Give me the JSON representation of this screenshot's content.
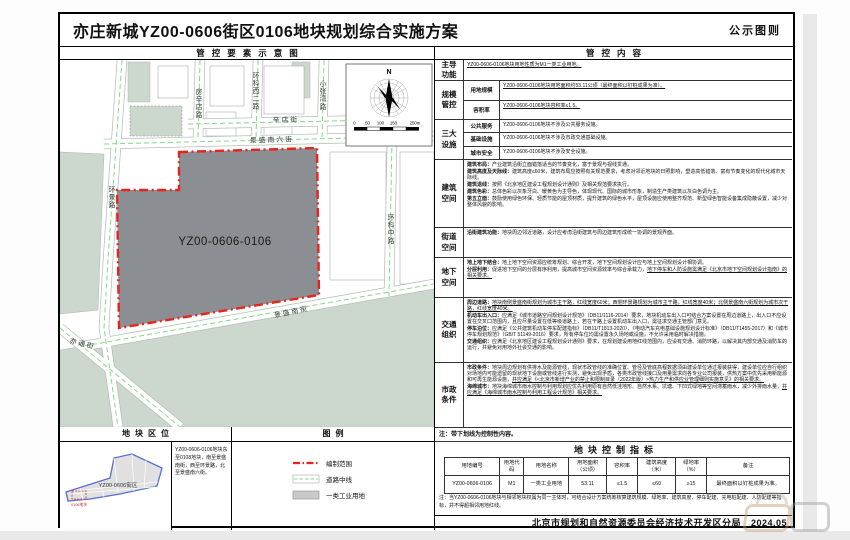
{
  "page": {
    "title": "亦庄新城YZ00-0606街区0106地块规划综合实施方案",
    "title_right": "公示图则",
    "footer_agency": "北京市规划和自然资源委员会经济技术开发区分局",
    "footer_date": "2024.05"
  },
  "map_panel": {
    "header": "管控要素示意图",
    "parcel_label": "YZ00-0606-0106",
    "north_label": "N",
    "scale_ticks": [
      "0",
      "50",
      "100",
      "150",
      "250m"
    ],
    "streets": [
      "房辛店路",
      "环科西二路",
      "辛店街",
      "小张湾路",
      "景盛南六街",
      "环景路",
      "环科中路",
      "景盛南街",
      "亦通街"
    ]
  },
  "location_panel": {
    "header": "地块区位",
    "district_label": "YZ00-0606街区",
    "parcel_label": "0106地块",
    "description": "YZ00-0606-0106地块东至0108地块，南至景盛南街，西至环景路，北至景盛南六街。"
  },
  "legend_panel": {
    "header": "图例",
    "items": [
      {
        "swatch": "red-dashdot-line",
        "label": "编制范围"
      },
      {
        "swatch": "road-centerline",
        "label": "道路中线"
      },
      {
        "swatch": "gray-fill",
        "label": "一类工业用地"
      }
    ]
  },
  "control_panel": {
    "header": "管控内容",
    "note": "注：带下划线为控制性内容。",
    "rows": [
      {
        "label": "主导功能",
        "cells": [
          {
            "sublabel": null,
            "paras": [
              [
                {
                  "t": "YZ00-0606-0106地块用地性质为M1一类工业用地。",
                  "u": 1
                }
              ]
            ]
          }
        ]
      },
      {
        "label": "规模管控",
        "cells": [
          {
            "sublabel": "用地规模",
            "paras": [
              [
                {
                  "t": "YZ00-0606-0106地块用地面积约53.11公顷（最终面积以钉桩成果为准）。",
                  "u": 1
                }
              ]
            ]
          },
          {
            "sublabel": "容积率",
            "paras": [
              [
                {
                  "t": "YZ00-0606-0106地块容积率≤1.5。",
                  "u": 1
                }
              ]
            ]
          }
        ]
      },
      {
        "label": "三大设施",
        "cells": [
          {
            "sublabel": "公共服务",
            "paras": [
              [
                {
                  "t": "YZ00-0606-0106地块不涉及公共服务设施。"
                }
              ]
            ]
          },
          {
            "sublabel": "基础设施",
            "paras": [
              [
                {
                  "t": "YZ00-0606-0106地块不涉及市政交通基础设施。"
                }
              ]
            ]
          },
          {
            "sublabel": "城市安全",
            "paras": [
              [
                {
                  "t": "YZ00-0606-0106地块不涉及安全设施。"
                }
              ]
            ]
          }
        ]
      },
      {
        "label": "建筑空间",
        "cells": [
          {
            "sublabel": null,
            "paras": [
              [
                {
                  "t": "建筑布局：",
                  "b": 1
                },
                {
                  "t": "产业建筑沿街立面错落适当的节奏变化，富于景观与视线贯通。"
                }
              ],
              [
                {
                  "t": "建筑高度及天际线：",
                  "b": 1
                },
                {
                  "t": "建筑高度≤60米，建筑布局应按照有关规范要求，考虑对邻近地块的日照影响，塑造高低错落、富有节奏变化的现代化城市天际线。"
                }
              ],
              [
                {
                  "t": "建筑退线：",
                  "b": 1
                },
                {
                  "t": "按照《北京地区建设工程规划设计通则》及相关规范要求执行。"
                }
              ],
              [
                {
                  "t": "建筑色彩：",
                  "b": 1
                },
                {
                  "t": "总体色彩以灰象牙白、暖黄色为主导色，体现现代、国际的城市形象，制造生产类建筑以灰白色调为主。"
                }
              ],
              [
                {
                  "t": "第五立面：",
                  "b": 1
                },
                {
                  "t": "鼓励使用绿色环保、轻质节能的屋顶材质，提升建筑的绿色水平，屋顶设施应使用整齐规范、新型绿色智能设备集成隐蔽设置，减少对整体风貌的影响。"
                }
              ]
            ]
          }
        ]
      },
      {
        "label": "街道空间",
        "cells": [
          {
            "sublabel": null,
            "paras": [
              [
                {
                  "t": "沿街建筑功能：",
                  "b": 1
                },
                {
                  "t": "地块周边邻近道路，设计应考虑沿街建筑与周边建筑形成统一协调的景观界面。"
                }
              ]
            ]
          }
        ]
      },
      {
        "label": "地下空间",
        "cells": [
          {
            "sublabel": null,
            "paras": [
              [
                {
                  "t": "地上地下结合：",
                  "b": 1
                },
                {
                  "t": "地上地下空间资源应统筹规划、综合开发，地下空间规划设计应与地上空间规划设计相协调。"
                }
              ],
              [
                {
                  "t": "分层利用：",
                  "b": 1
                },
                {
                  "t": "促进地下空间的分层有序利用，提高城市空间资源效率与综合承载力，"
                },
                {
                  "t": "地下停车和人防设施需满足《北京市地下空间规划设计指南》的相关要求。",
                  "u": 1
                }
              ]
            ]
          }
        ]
      },
      {
        "label": "交通组织",
        "cells": [
          {
            "sublabel": null,
            "paras": [
              [
                {
                  "t": "周边道路：",
                  "b": 1
                },
                {
                  "t": "地块南侧景盛南街规划为城市主干路，红线宽度60米；西侧环景路规划为城市主干路，红线宽度40米；北侧景盛南六街规划为城市次干路，红线宽度40米。",
                  "u": 1
                }
              ],
              [
                {
                  "t": "机动车出入口：",
                  "b": 1
                },
                {
                  "t": "应满足《城市道路空间规划设计规范》（DB11/1116-2014）要求，地块机动车出入口可结合方案设置在周边道路上，出入口不应设置在交叉口范围内，且应尽量设置在低等级道路上，若在干路上设置机动车出入口，需征求交通主管部门意见。"
                }
              ],
              [
                {
                  "t": "停车泊位：",
                  "b": 1
                },
                {
                  "t": "应满足《公共建筑机动车停车配建指标》（DB11/T1813-2020）、《电动汽车充电基础设施规划设计标准》（DB11/T1455-2017）和《城市停车规划规范》（GB/T 51149-2016）要求，所有停车位均需设置永久场地或设施，不允许采用临时解决措施。"
                }
              ],
              [
                {
                  "t": "交通组织：",
                  "b": 1
                },
                {
                  "t": "应满足《北京地区建设工程规划设计通则》要求，在规划建设用地红线范围内，应设有交通、消防环路，以解决其内部交通及消防车的运行，并避免对用地外社会交通的影响。"
                }
              ]
            ]
          }
        ]
      },
      {
        "label": "市政条件",
        "cells": [
          {
            "sublabel": null,
            "paras": [
              [
                {
                  "t": "市政条件：",
                  "b": 1
                },
                {
                  "t": "地块周边规划有供排水及能源管线，现状市政管线的准确位置、管径及管底高程数据须由建设单位通过报装获得，建设单位应自行组织对场地内可能遗留的现状地下设施或管线进行实测，避免出现矛盾，各类市政管线接口及用量需求向各专业公司报装，供热方案中优先采用新能源和可再生能源设施，"
                },
                {
                  "t": "并应满足《<北京市新增产业的禁止和限制目录（2022年版）>热力生产和供应业管理细则实施意见》的相关要求。",
                  "u": 1
                }
              ],
              [
                {
                  "t": "海绵城市：",
                  "b": 1
                },
                {
                  "t": "地块海绵城市雨水控制与利用规划应优先利用原有自然低洼地形、自然水系、坑塘、下凹式绿地等空间滞蓄雨水，减少外排雨水量，"
                },
                {
                  "t": "并应满足《海绵城市雨水控制与利用工程设计规范》相关要求。",
                  "u": 1
                }
              ]
            ]
          }
        ]
      }
    ]
  },
  "indicator_table": {
    "title": "地块控制指标",
    "columns": [
      "用地编号",
      "用地代码",
      "用地名称",
      "用地面积\n（公顷）",
      "容积率",
      "建筑高度\n（米）",
      "绿地率\n（%）",
      "备注"
    ],
    "rows": [
      [
        "YZ00-0606-0106",
        "M1",
        "一类工业用地",
        "53.11",
        "≤1.5",
        "≤60",
        "≥15",
        "最终面积以钉桩成果为准。"
      ]
    ],
    "note": "注：当YZ00-0606-0106地块与相邻地块权属为同一主体时，可结合设计方案统筹核算建筑规模、绿地率、建筑高度、停车配建、充电桩配建、人防配建等指标，并不得超相邻用地红线。"
  },
  "colors": {
    "parcel_gray": "#8b8e92",
    "boundary_red": "#e8231a",
    "block_sage": "#ccd7cd",
    "centerline_green": "#86d989",
    "district_blue": "#5a6cd0"
  }
}
